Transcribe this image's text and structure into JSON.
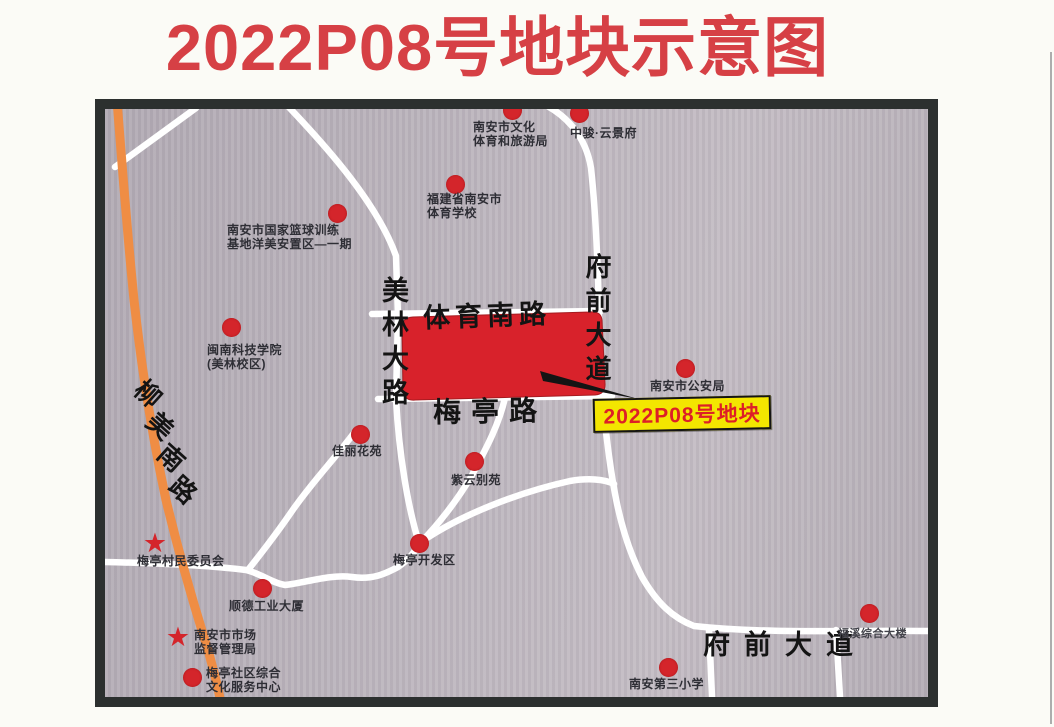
{
  "title": {
    "text": "2022P08号地块示意图",
    "color": "#d64045"
  },
  "map": {
    "background": "#b7b0b8",
    "frame_color": "#2c302f",
    "road_color": "#ffffff",
    "highway_color": "#ef8d44",
    "marker_color": "#d4252b",
    "plot": {
      "fill": "#d8222b",
      "label": {
        "text": "2022P08号地块",
        "bg": "#f3e600",
        "text_color": "#dd1f27",
        "border_color": "#141414",
        "x": 593,
        "y": 397,
        "w": 174,
        "h": 30
      }
    },
    "road_labels": [
      {
        "id": "liumei-south-road",
        "text": "柳美南路",
        "type": "diagonal",
        "start_x": 135,
        "start_y": 381,
        "dx": 11.5,
        "dy": 32,
        "rot": 42,
        "size": 26
      },
      {
        "id": "meilin-avenue",
        "text": "美林大路",
        "type": "vertical",
        "x": 374,
        "y": 276,
        "size": 27,
        "spacing": 7
      },
      {
        "id": "tiyu-south-road",
        "text": "体育南路",
        "type": "horizontal",
        "x": 423,
        "y": 294,
        "size": 27,
        "spacing": 5,
        "rot": -2
      },
      {
        "id": "meiting-road",
        "text": "梅亭路",
        "type": "horizontal",
        "x": 433,
        "y": 390,
        "size": 28,
        "spacing": 10,
        "rot": -1
      },
      {
        "id": "fuqian-avenue-vertical",
        "text": "府前大道",
        "type": "vertical",
        "x": 579,
        "y": 253,
        "size": 26,
        "spacing": 8
      },
      {
        "id": "fuqian-avenue-horizontal",
        "text": "府前大道",
        "type": "horizontal",
        "x": 703,
        "y": 623,
        "size": 27,
        "spacing": 14,
        "rot": 0
      }
    ],
    "pois": [
      {
        "id": "nanan-culture-sports-tourism-bureau",
        "marker": "dot",
        "mx": 512,
        "my": 110,
        "lx": 473,
        "ly": 121,
        "lines": [
          "南安市文化",
          "体育和旅游局"
        ]
      },
      {
        "id": "zhongjun-yunjingfu",
        "marker": "dot",
        "mx": 579,
        "my": 113,
        "lx": 570,
        "ly": 127,
        "lines": [
          "中骏·云景府"
        ]
      },
      {
        "id": "fujian-nanan-sports-school",
        "marker": "dot",
        "mx": 455,
        "my": 184,
        "lx": 427,
        "ly": 193,
        "lines": [
          "福建省南安市",
          "体育学校"
        ]
      },
      {
        "id": "national-basketball-training-base",
        "marker": "dot",
        "mx": 337,
        "my": 213,
        "lx": 227,
        "ly": 224,
        "lines": [
          "南安市国家篮球训练",
          "基地洋美安置区—一期"
        ]
      },
      {
        "id": "minnan-tech-college",
        "marker": "dot",
        "mx": 231,
        "my": 327,
        "lx": 207,
        "ly": 344,
        "lines": [
          "闽南科技学院",
          "(美林校区)"
        ]
      },
      {
        "id": "nanan-public-security-bureau",
        "marker": "dot",
        "mx": 685,
        "my": 368,
        "lx": 650,
        "ly": 380,
        "lines": [
          "南安市公安局"
        ]
      },
      {
        "id": "jiali-garden",
        "marker": "dot",
        "mx": 360,
        "my": 434,
        "lx": 332,
        "ly": 445,
        "lines": [
          "佳丽花苑"
        ]
      },
      {
        "id": "ziyun-villa",
        "marker": "dot",
        "mx": 474,
        "my": 461,
        "lx": 451,
        "ly": 474,
        "lines": [
          "紫云别苑"
        ]
      },
      {
        "id": "meiting-development-zone",
        "marker": "dot",
        "mx": 419,
        "my": 543,
        "lx": 393,
        "ly": 554,
        "lines": [
          "梅亭开发区"
        ]
      },
      {
        "id": "meiting-village-committee",
        "marker": "star",
        "mx": 155,
        "my": 544,
        "lx": 137,
        "ly": 555,
        "lines": [
          "梅亭村民委员会"
        ]
      },
      {
        "id": "shunde-industrial-building",
        "marker": "dot",
        "mx": 262,
        "my": 588,
        "lx": 229,
        "ly": 600,
        "lines": [
          "顺德工业大厦"
        ]
      },
      {
        "id": "nanan-market-supervision-bureau",
        "marker": "star",
        "mx": 178,
        "my": 638,
        "lx": 194,
        "ly": 629,
        "lines": [
          "南安市市场",
          "监督管理局"
        ]
      },
      {
        "id": "meiting-community-culture-center",
        "marker": "dot",
        "mx": 192,
        "my": 677,
        "lx": 206,
        "ly": 667,
        "lines": [
          "梅亭社区综合",
          "文化服务中心"
        ]
      },
      {
        "id": "nanan-third-primary-school",
        "marker": "dot",
        "mx": 668,
        "my": 667,
        "lx": 629,
        "ly": 678,
        "lines": [
          "南安第三小学"
        ]
      },
      {
        "id": "fuxi-comprehensive-building",
        "marker": "dot",
        "mx": 869,
        "my": 613,
        "lx": 838,
        "ly": 628,
        "lines": [
          "福溪综合大楼"
        ],
        "small": true
      }
    ]
  }
}
